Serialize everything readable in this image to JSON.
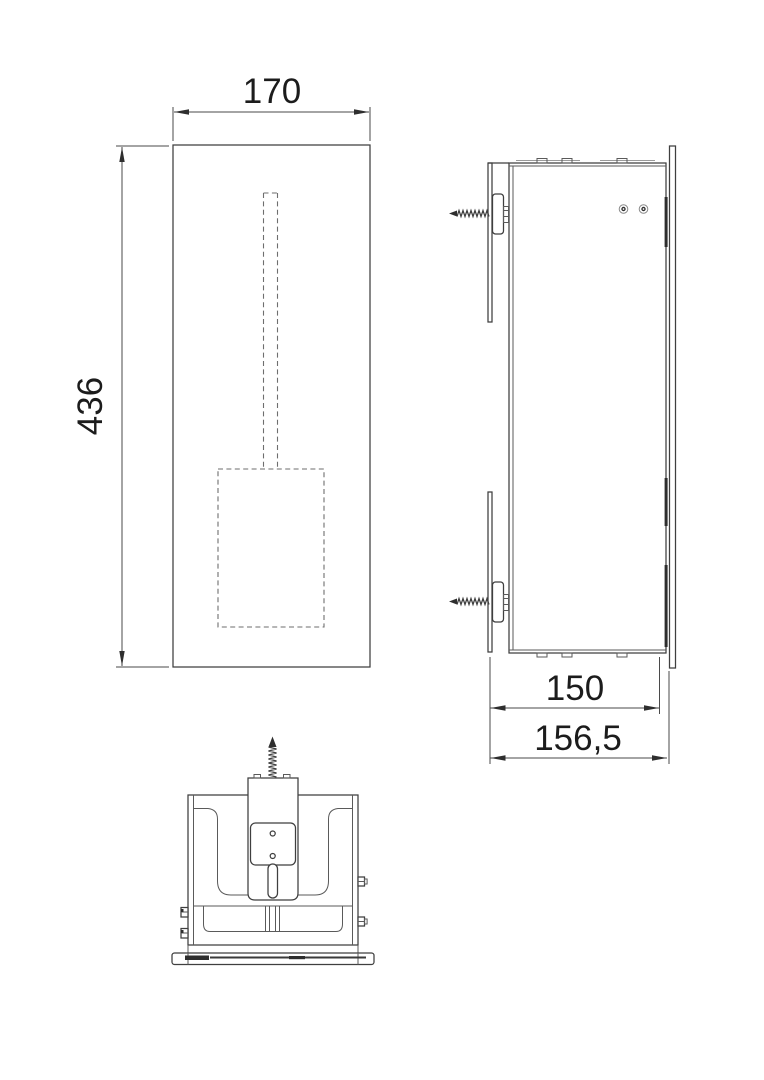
{
  "drawing": {
    "background_color": "#ffffff",
    "line_color": "#3f3f3f",
    "dashed_color": "#6e6e6e",
    "text_color": "#1c1c1c",
    "views": {
      "front": {
        "name": "front-view",
        "dim_width": "170",
        "dim_height": "436"
      },
      "side": {
        "name": "side-view",
        "dim_depth_inner": "150",
        "dim_depth_overall": "156,5"
      },
      "bottom": {
        "name": "bottom-view"
      }
    }
  }
}
